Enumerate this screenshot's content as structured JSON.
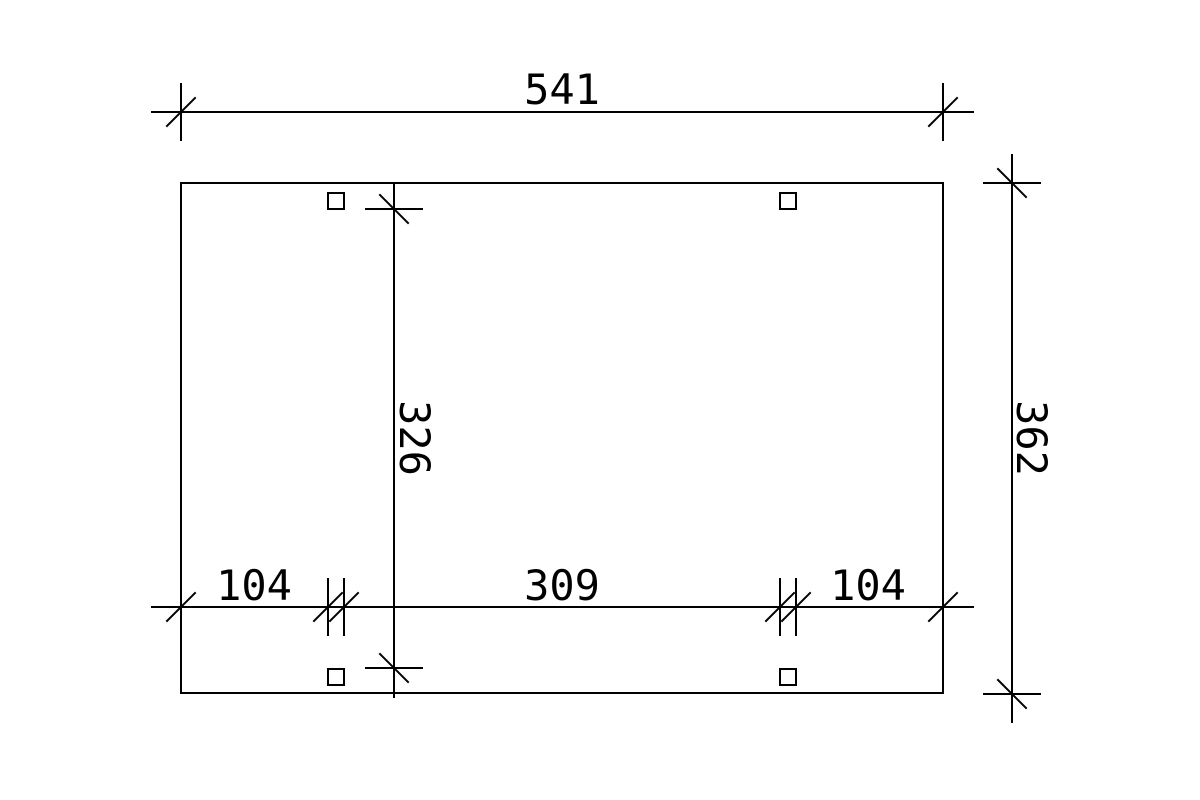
{
  "colors": {
    "background": "#ffffff",
    "line": "#000000",
    "text": "#000000"
  },
  "drawing_type": "technical-dimension-plan",
  "dimensions": {
    "total_width": "541",
    "total_depth": "362",
    "inner_depth": "326",
    "left_overhang": "104",
    "post_span": "309",
    "right_overhang": "104"
  }
}
